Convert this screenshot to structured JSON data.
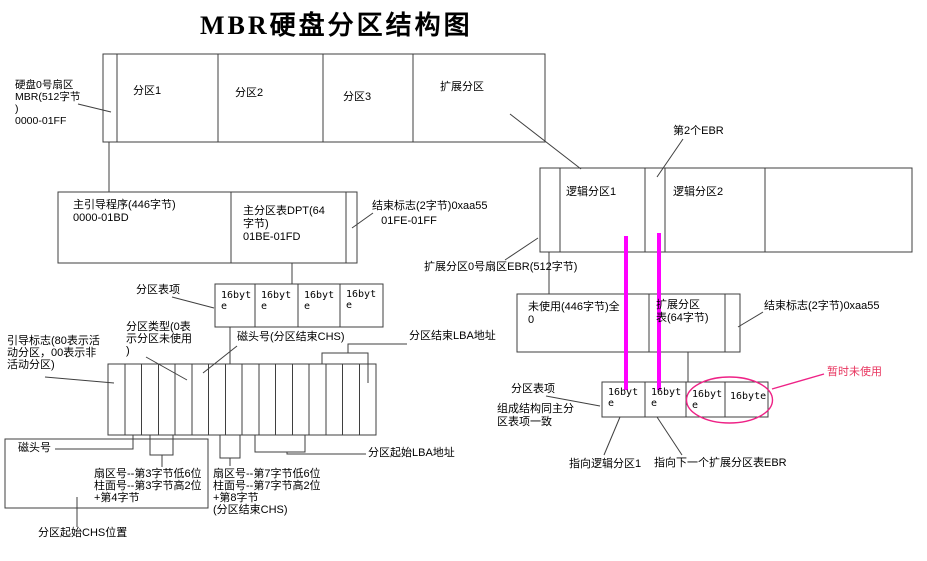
{
  "title": "MBR硬盘分区结构图",
  "colors": {
    "line": "#3f3f3f",
    "magenta": "#ff00ff",
    "pink": "#ee2286",
    "red_text": "#e8355f"
  },
  "top_bar": {
    "mbr_sector_label": "硬盘0号扇区\nMBR(512字节\n)\n0000-01FF",
    "partition1": "分区1",
    "partition2": "分区2",
    "partition3": "分区3",
    "extended": "扩展分区"
  },
  "logical_bar": {
    "logical1": "逻辑分区1",
    "logical2": "逻辑分区2",
    "second_ebr_label": "第2个EBR",
    "ebr_sector_label": "扩展分区0号扇区EBR(512字节)"
  },
  "mbr_sector_box": {
    "boot_code": "主引导程序(446字节)\n0000-01BD",
    "dpt": "主分区表DPT(64\n字节)\n01BE-01FD",
    "end_flag": "结束标志(2字节)0xaa55\n   01FE-01FF"
  },
  "ebr_sector_box": {
    "unused": "未使用(446字节)全\n0",
    "ext_table": "扩展分区\n表(64字节)",
    "end_flag": "结束标志(2字节)0xaa55"
  },
  "pte_row_left": {
    "label": "分区表项",
    "cells": [
      "16byte",
      "16byte",
      "16byte",
      "16byte"
    ]
  },
  "pte_row_right": {
    "label": "分区表项",
    "note": "组成结构同主分\n区表项一致",
    "cells": [
      "16byte",
      "16byte",
      "16byte",
      "16byte"
    ],
    "point_logical1": "指向逻辑分区1",
    "point_next_ebr": "指向下一个扩展分区表EBR",
    "temp_unused": "暂时未使用"
  },
  "byte_bar": {
    "boot_flag": "引导标志(80表示活\n动分区，00表示非\n活动分区)",
    "part_type": "分区类型(0表\n示分区未使用\n)",
    "head_end": "磁头号(分区结束CHS)",
    "end_lba": "分区结束LBA地址",
    "start_lba": "分区起始LBA地址",
    "head": "磁头号",
    "start_chs_bytes": "扇区号--第3字节低6位\n柱面号--第3字节高2位\n+第4字节",
    "end_chs_bytes": "扇区号--第7字节低6位\n柱面号--第7字节高2位\n+第8字节\n(分区结束CHS)",
    "start_chs": "分区起始CHS位置"
  }
}
